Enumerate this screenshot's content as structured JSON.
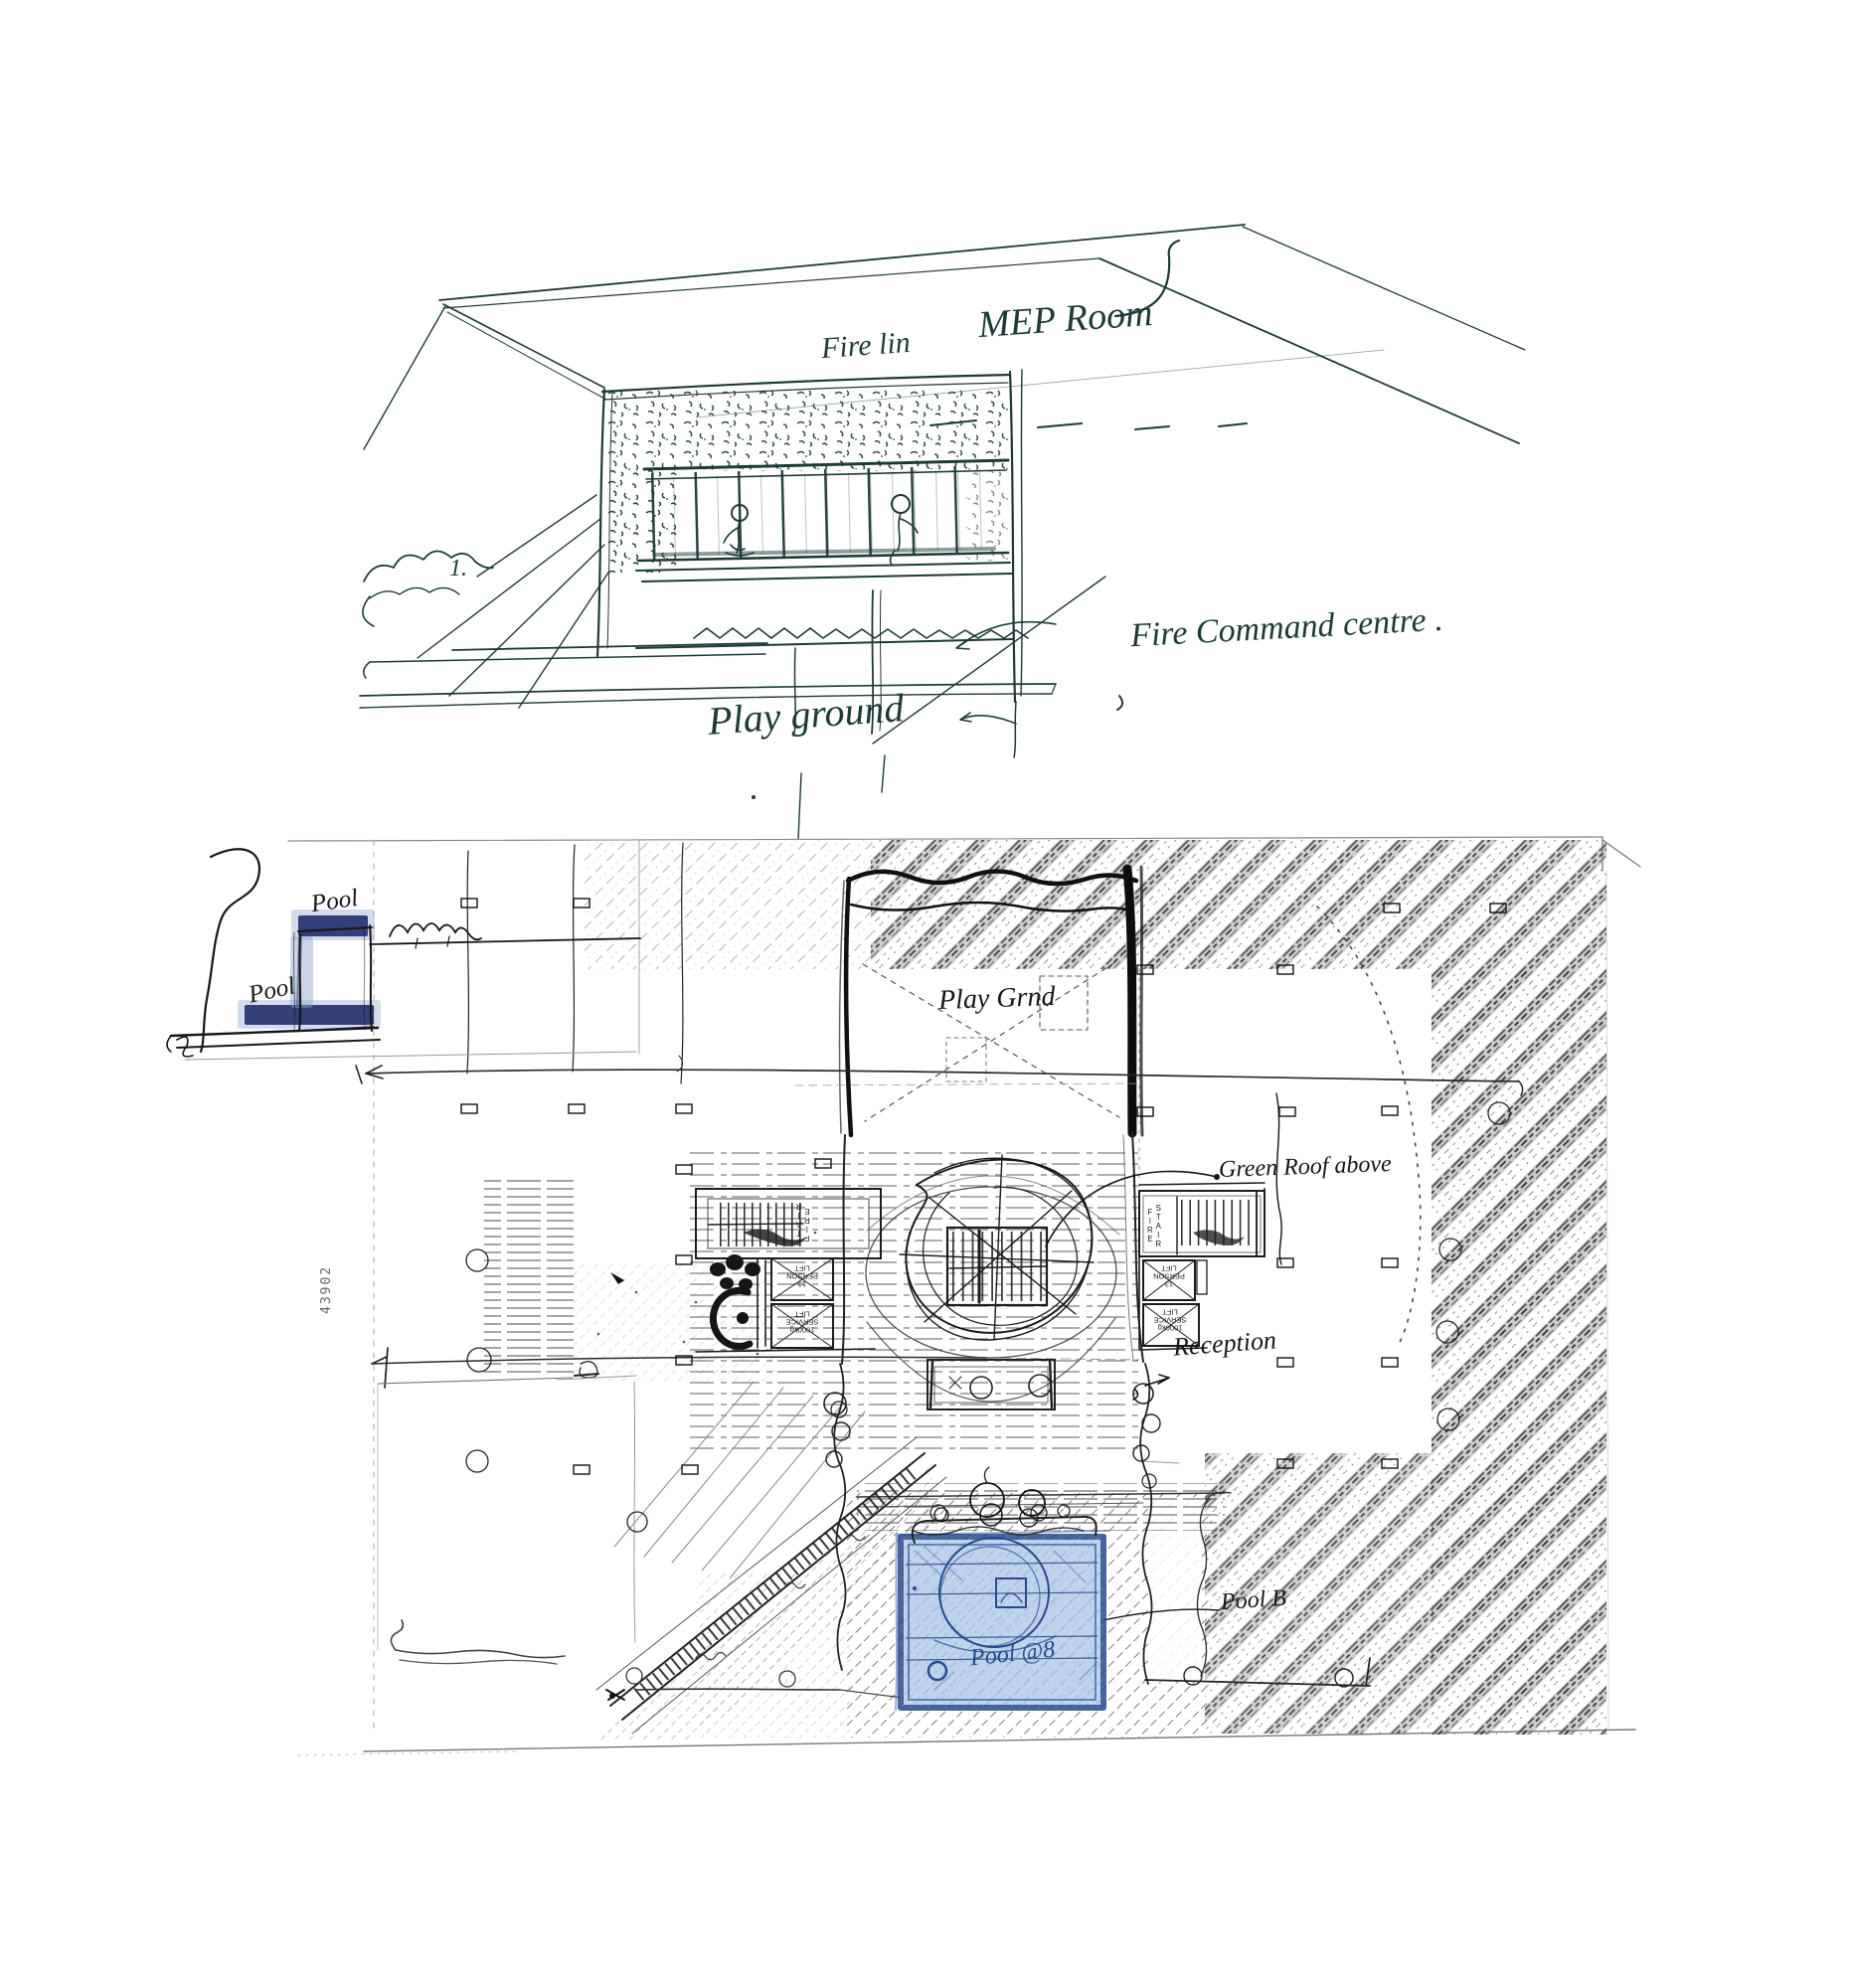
{
  "palette": {
    "paper": "#ffffff",
    "ink_teal": "#1d3a37",
    "ink_black": "#161616",
    "hatch_gray": "#8a8a8a",
    "pencil_gray": "#9f9f9f",
    "pool_fill": "#b7cdea",
    "pool_border": "#2e4f8e",
    "pool_ink": "#274a8a",
    "crayon_navy": "#27336f",
    "crayon_halo": "#8ea3cc"
  },
  "section_sketch": {
    "labels": {
      "mep_room": "MEP Room",
      "fire_line": "Fire lin",
      "fire_command_centre": "Fire Command centre .",
      "play_ground": "Play ground",
      "note_mark": "1."
    }
  },
  "plan_sketch": {
    "labels": {
      "mini_pool_upper": "Pool",
      "mini_pool_lower": "Pool",
      "play_ground": "Play Grnd",
      "green_roof": "Green Roof above",
      "reception": "Reception",
      "pool_b": "Pool B",
      "pool_main": "Pool @8",
      "ref_number": "43902"
    },
    "core_left": {
      "fire_stair": "FIRE\nSTAIR",
      "person_lift": "13\nPERSON\nLIFT",
      "service_lift": "1000kg\nSERVICE\nLIFT"
    },
    "core_right": {
      "fire_stair": "FIRE\nSTAIR",
      "person_lift": "13\nPERSON\nLIFT",
      "service_lift": "1000kg\nSERVICE\nLIFT"
    }
  }
}
